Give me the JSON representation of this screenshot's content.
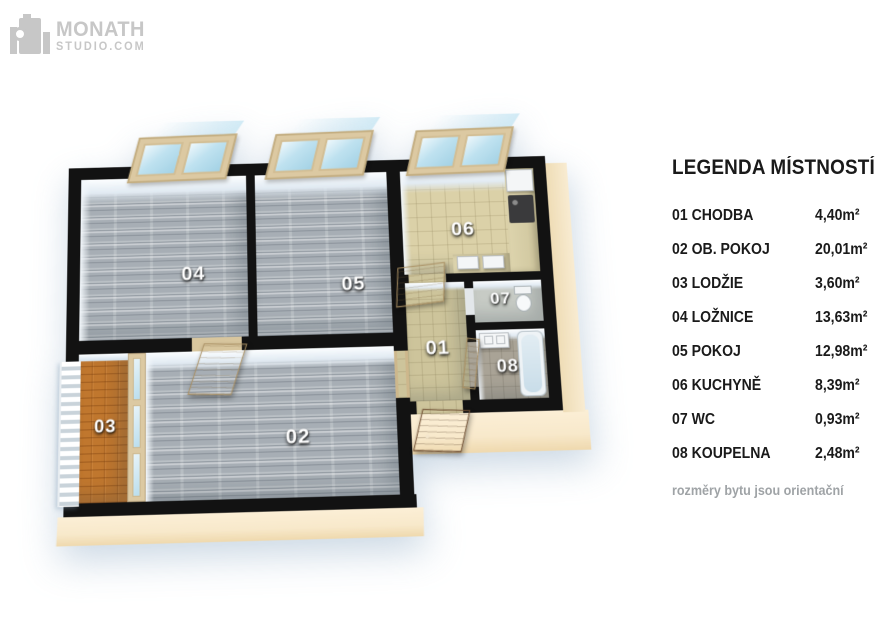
{
  "logo": {
    "brand": "MONATH",
    "suffix": "STUDIO.COM"
  },
  "plan": {
    "labels": {
      "r01": "01",
      "r02": "02",
      "r03": "03",
      "r04": "04",
      "r05": "05",
      "r06": "06",
      "r07": "07",
      "r08": "08"
    }
  },
  "legend": {
    "title": "LEGENDA MÍSTNOSTÍ",
    "rows": [
      {
        "label": "01 CHODBA",
        "area": "4,40m²"
      },
      {
        "label": "02 OB. POKOJ",
        "area": "20,01m²"
      },
      {
        "label": "03 LODŽIE",
        "area": "3,60m²"
      },
      {
        "label": "04 LOŽNICE",
        "area": "13,63m²"
      },
      {
        "label": "05 POKOJ",
        "area": "12,98m²"
      },
      {
        "label": "06 KUCHYNĚ",
        "area": "8,39m²"
      },
      {
        "label": "07 WC",
        "area": "0,93m²"
      },
      {
        "label": "08 KOUPELNA",
        "area": "2,48m²"
      }
    ],
    "note": "rozměry bytu jsou orientační"
  },
  "colors": {
    "wall": "#121212",
    "wood-floor": "#aeb5bb",
    "tile-floor": "#dbd1a8",
    "hall-floor": "#cdc49b",
    "loggia-floor": "#c0772e",
    "bath-floor": "#a9a396",
    "base": "#f8e9cb",
    "window-frame": "#dcc9a2",
    "window-glass": "#bfe2f0",
    "door": "#d3ba8e",
    "entry-door": "#9c6f49",
    "logo-gray": "#c7c7c7",
    "note-gray": "#9fa3a6"
  }
}
